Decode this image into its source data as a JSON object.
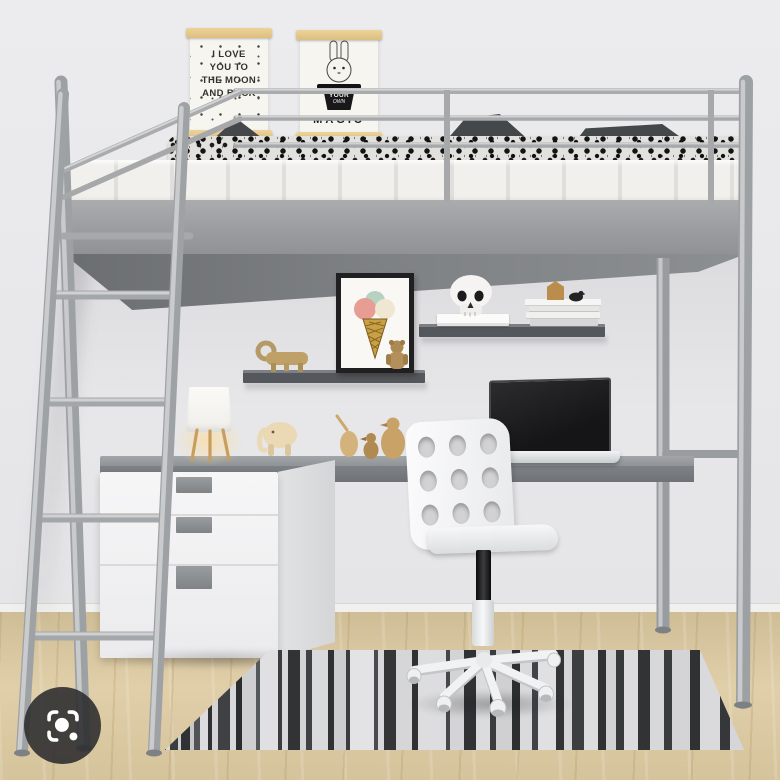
{
  "scene": {
    "subject": "silver metal loft bed with desk workstation, shelves, drawer unit, white swivel chair and striped rug"
  },
  "posters": {
    "moon": {
      "line1": "I LOVE",
      "line2": "YOU TO",
      "line3": "THE MOON",
      "line4": "AND BACK"
    },
    "magic": {
      "hat_line1": "YOUR",
      "hat_line2": "OWN",
      "title": "MAGIC"
    }
  },
  "lens_button": {
    "icon": "google-lens-icon"
  },
  "colors": {
    "frame_silver": "#a8abae",
    "wall": "#e8e8ea",
    "desk_gray": "#85888b",
    "shelf_gray": "#55585b",
    "floor_wood": "#d9c7a0",
    "chair_white": "#f4f5f6",
    "duvet_pattern": "#151515",
    "drawer_white": "#f4f4f5",
    "lens_button_bg": "#2c2c2e"
  }
}
